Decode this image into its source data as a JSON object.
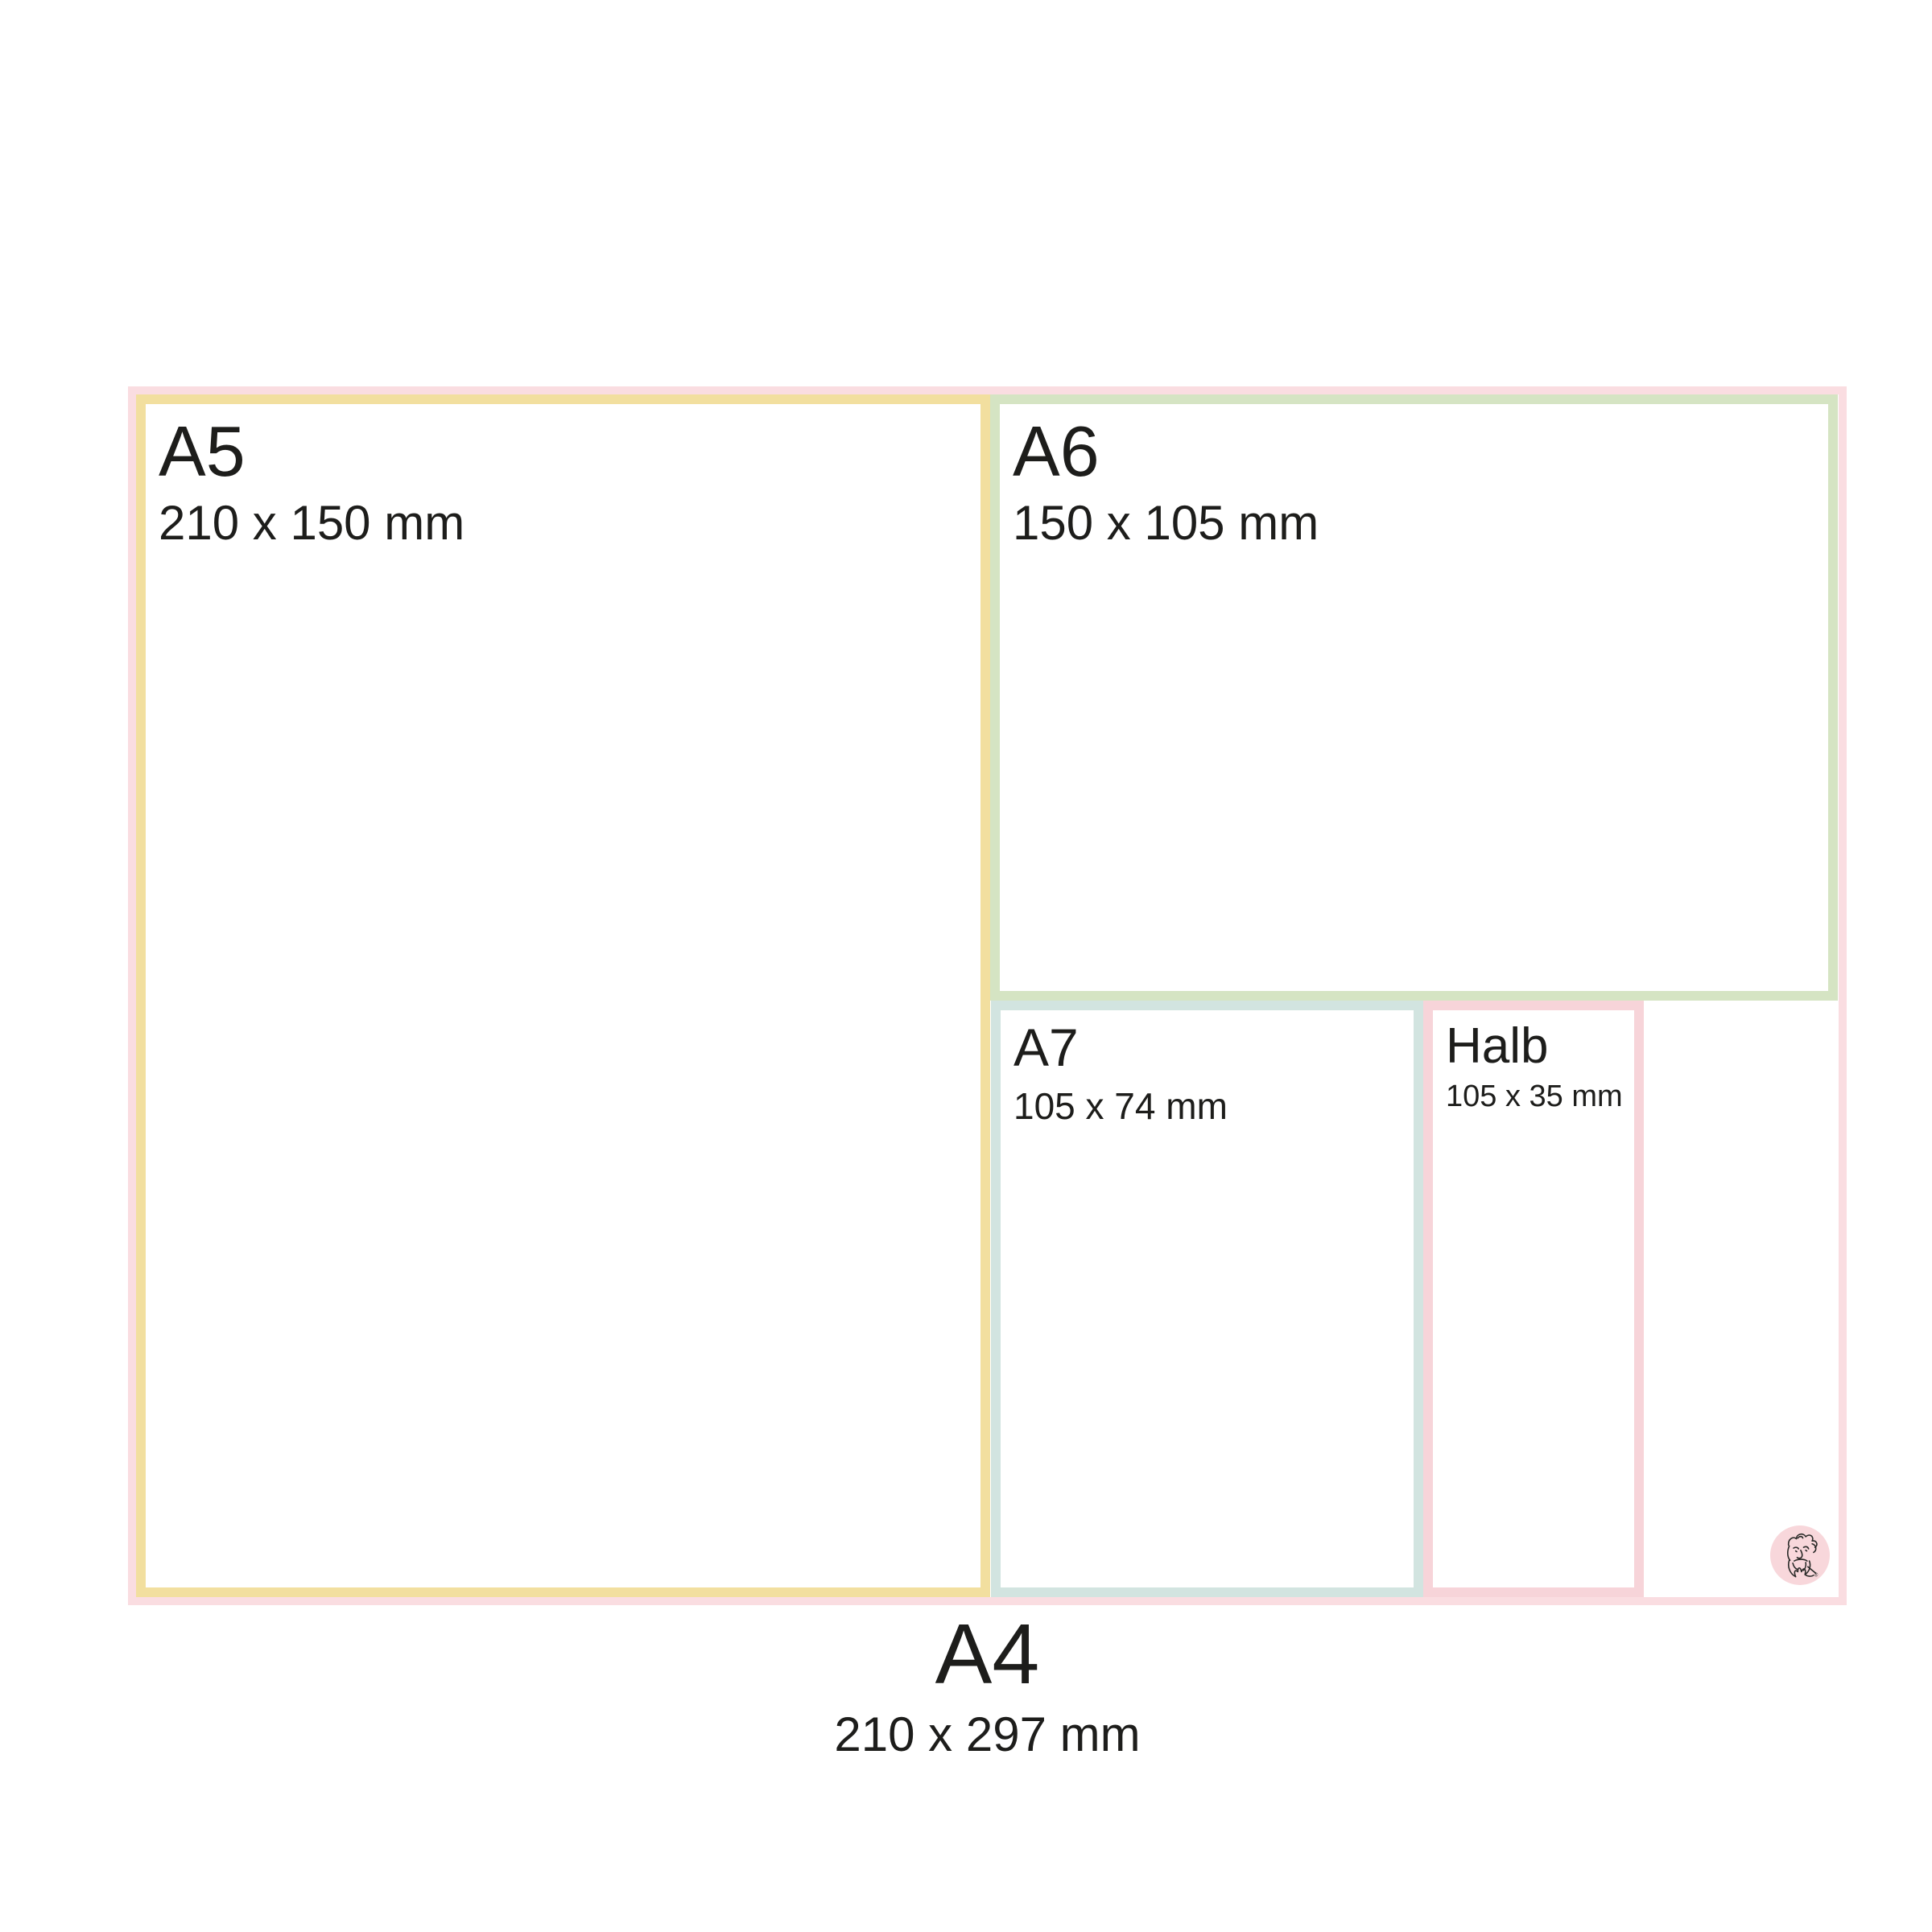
{
  "diagram_title": "Paper size comparison",
  "sizes": {
    "a5": {
      "label": "A5",
      "dimensions": "210 x 150 mm",
      "border_color": "#F2DF9F"
    },
    "a6": {
      "label": "A6",
      "dimensions": "150 x 105 mm",
      "border_color": "#D5E4C3"
    },
    "a7": {
      "label": "A7",
      "dimensions": "105 x 74 mm",
      "border_color": "#D2E4E0"
    },
    "halb": {
      "label": "Halb",
      "dimensions": "105 x 35 mm",
      "border_color": "#F7D4D9"
    },
    "a4": {
      "label": "A4",
      "dimensions": "210 x 297 mm",
      "border_color": "#FADDE1"
    }
  },
  "logo": {
    "icon": "bearded-man-sketch",
    "circle_color": "#F8D7DB",
    "stroke_color": "#2a2a28",
    "registered_mark": "®"
  },
  "colors": {
    "background": "#FFFFFF",
    "text": "#1D1D1B"
  }
}
